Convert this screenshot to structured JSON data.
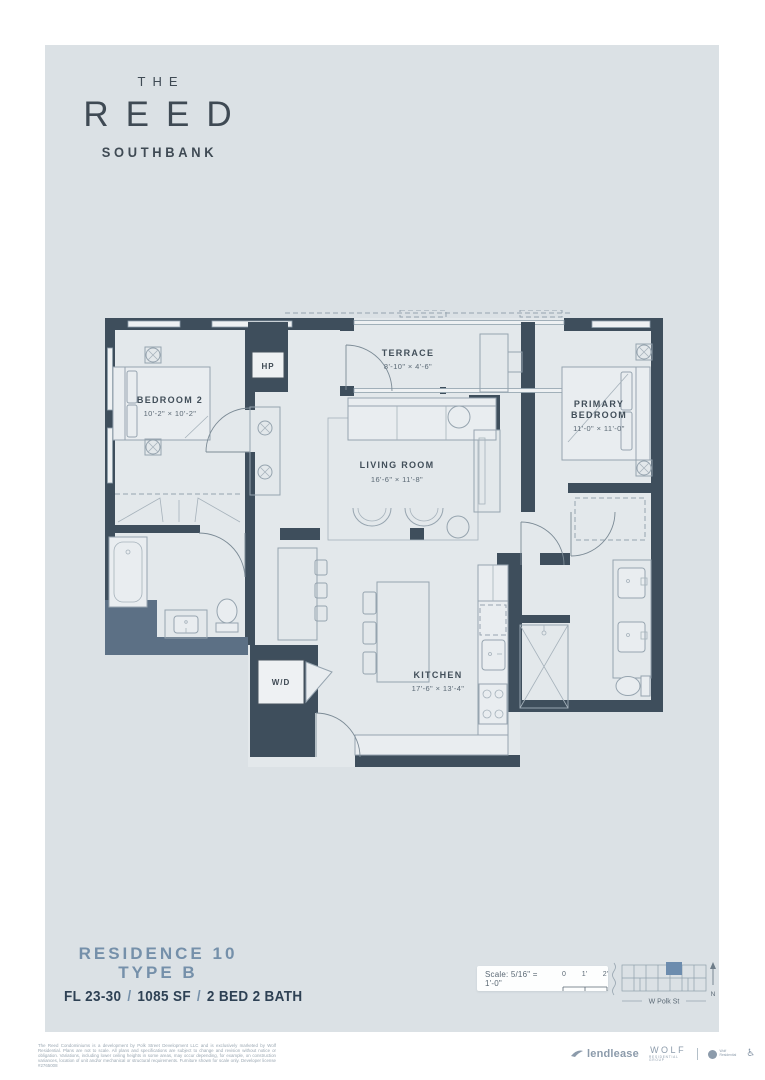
{
  "brand": {
    "the": "THE",
    "name": "REED",
    "sub": "SOUTHBANK"
  },
  "plan": {
    "bedroom2_name": "BEDROOM 2",
    "bedroom2_dims": "10'-2\" × 10'-2\"",
    "terrace_name": "TERRACE",
    "terrace_dims": "8'-10\" × 4'-6\"",
    "living_name": "LIVING ROOM",
    "living_dims": "16'-6\" × 11'-8\"",
    "primary_name1": "PRIMARY",
    "primary_name2": "BEDROOM",
    "primary_dims": "11'-0\" × 11'-0\"",
    "kitchen_name": "KITCHEN",
    "kitchen_dims": "17'-6\" × 13'-4\"",
    "wd": "W/D",
    "hp": "HP"
  },
  "residence": {
    "line1": "RESIDENCE 10",
    "line2": "TYPE B",
    "floors": "FL 23-30",
    "area": "1085 SF",
    "beds": "2 BED 2 BATH",
    "sep": "/"
  },
  "scalebox": {
    "label": "Scale: 5/16\" = 1'-0\"",
    "ticks": [
      "0",
      "1'",
      "2'"
    ]
  },
  "map": {
    "street": "W Polk St",
    "north": "N"
  },
  "footer": {
    "disclaimer": "The Reed Condominiums is a development by Polk Street Development LLC and is exclusively marketed by Wolf Residential. Plans are not to scale. All plans and specifications are subject to change and revision without notice or obligation. Variations, including lower ceiling heights in some areas, may occur depending, for example, on construction variances, location of unit and/or mechanical or structural requirements. Furniture shown for scale only. Developer license #2765008",
    "lendlease": "lendlease",
    "wolf": "WOLF",
    "wolf_sub": "RESIDENTIAL GROUP",
    "wolfres_line1": "Wolf",
    "wolfres_line2": "Residential"
  }
}
